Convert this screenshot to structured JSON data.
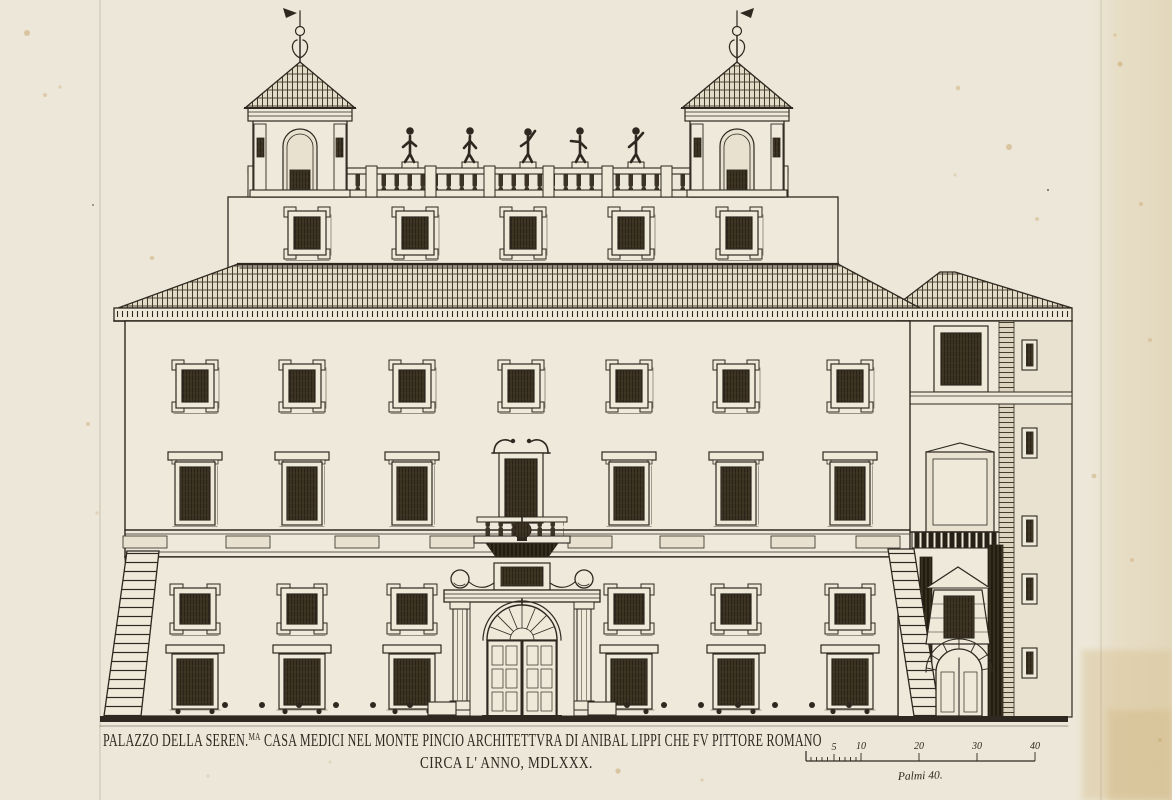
{
  "plate": {
    "type": "etching-architectural-elevation",
    "subject": "Facade elevation of the Villa Medici on the Pincian Hill, Rome"
  },
  "caption": {
    "line1_prefix": "PALAZZO DELLA SEREN.",
    "line1_superscript": "MA",
    "line1_rest": " CASA MEDICI NEL MONTE PINCIO ARCHITETTVRA DI ANIBAL LIPPI CHE FV PITTORE ROMANO",
    "line2": "CIRCA L' ANNO, MDLXXX."
  },
  "scale_bar": {
    "ticks": [
      "5",
      "10",
      "20",
      "30",
      "40"
    ],
    "label": "Palmi  40.",
    "unit": "palmi",
    "max": 40
  },
  "colors": {
    "paper": "#ece7d8",
    "ink": "#2e2820",
    "wall": "#eee9da",
    "page_edge_tint": "#e2d3b2",
    "foxing": "#c8a46a"
  }
}
